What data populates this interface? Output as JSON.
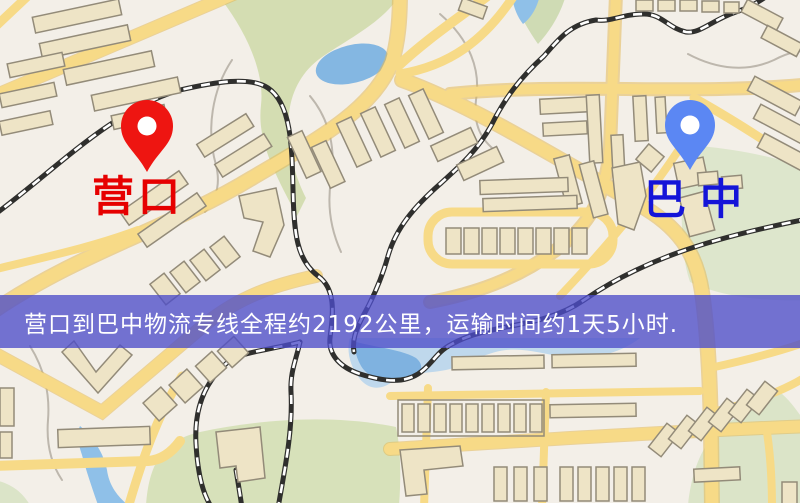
{
  "map": {
    "origin": {
      "label": "营口",
      "pin_icon": "red-location-pin-icon",
      "pin_color": "#ee1511",
      "label_color": "#e60000"
    },
    "destination": {
      "label": "巴中",
      "pin_icon": "blue-location-pin-icon",
      "pin_color": "#5b87f3",
      "label_color": "#1414d8"
    },
    "banner": {
      "text": "营口到巴中物流专线全程约2192公里，运输时间约1天5小时.",
      "background": "#4d4dc9",
      "text_color": "#ffffff",
      "distance_km": "2192",
      "duration": "1天5小时"
    },
    "palette": {
      "road": "#f7da87",
      "road_casing": "#e8c160",
      "railway": "#2f2f2d",
      "water": "#84b7e2",
      "park": "#d6deb4",
      "building_fill": "#eee4c6",
      "building_stroke": "#938b79",
      "background": "#f3efe8"
    }
  }
}
